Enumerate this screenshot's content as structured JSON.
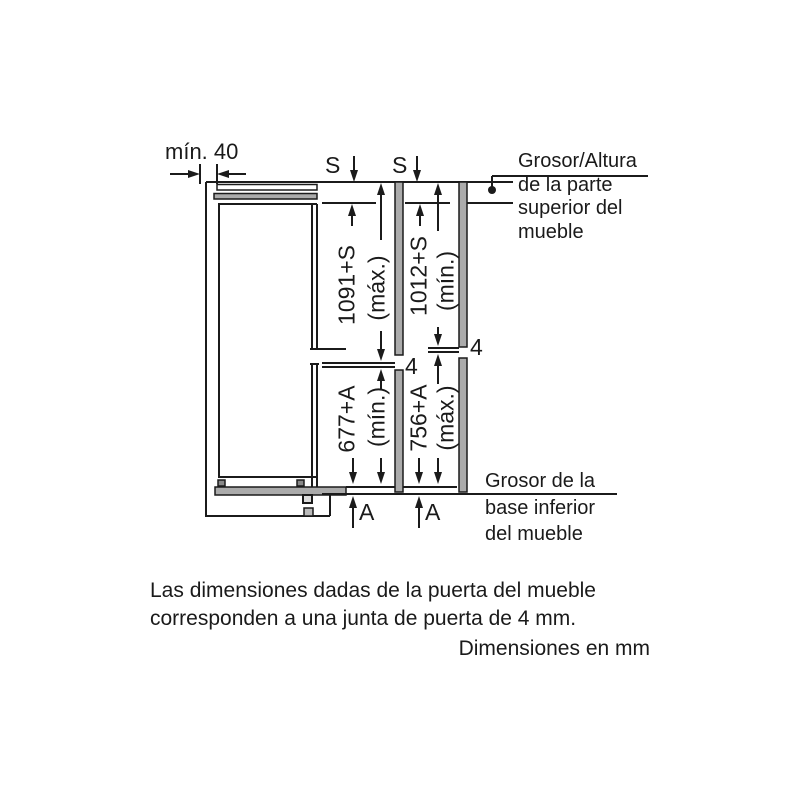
{
  "colors": {
    "line": "#1b1b1b",
    "panel_gray": "#ababab",
    "background": "#ffffff"
  },
  "diagram": {
    "min_clearance": "mín. 40",
    "top_panel_s_left": "S",
    "top_panel_s_right": "S",
    "top_callout": "Grosor/Altura\nde la parte\nsuperior del\nmueble",
    "upper_door_max": "1091+S",
    "upper_door_max_qualifier": "(máx.)",
    "upper_door_min": "1012+S",
    "upper_door_min_qualifier": "(mín.)",
    "lower_door_min": "677+A",
    "lower_door_min_qualifier": "(mín.)",
    "lower_door_max": "756+A",
    "lower_door_max_qualifier": "(máx.)",
    "door_gap_left": "4",
    "door_gap_right": "4",
    "base_a_left": "A",
    "base_a_right": "A",
    "bottom_callout": "Grosor de la\nbase inferior\ndel mueble"
  },
  "notes": {
    "door_note": "Las dimensiones dadas de la puerta del mueble\ncorresponden a una junta de puerta de 4 mm.",
    "units_note": "Dimensiones en mm"
  }
}
